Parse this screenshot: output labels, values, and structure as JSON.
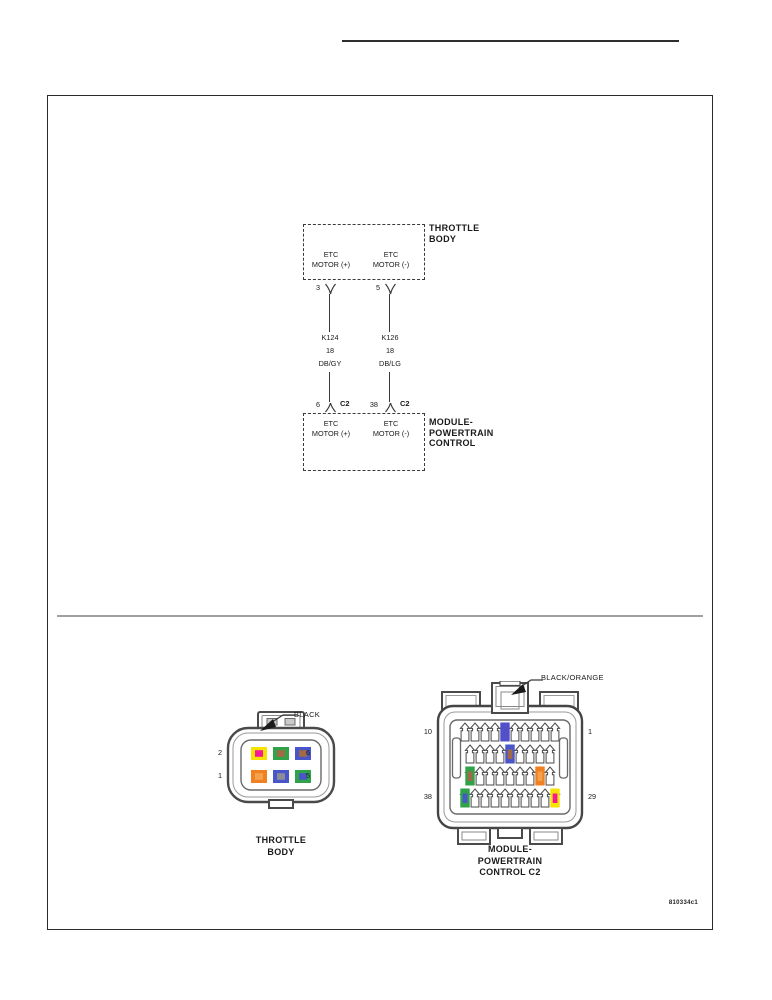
{
  "page": {
    "doc_code": "810334c1"
  },
  "schematic": {
    "tb_title_l1": "THROTTLE",
    "tb_title_l2": "BODY",
    "tb_sig_left_l1": "ETC",
    "tb_sig_left_l2": "MOTOR (+)",
    "tb_sig_right_l1": "ETC",
    "tb_sig_right_l2": "MOTOR (-)",
    "tb_pin_left": "3",
    "tb_pin_right": "5",
    "wire_left_l1": "K124",
    "wire_left_l2": "18",
    "wire_left_l3": "DB/GY",
    "wire_right_l1": "K126",
    "wire_right_l2": "18",
    "wire_right_l3": "DB/LG",
    "pcm_pin_left": "6",
    "pcm_conn_left": "C2",
    "pcm_pin_right": "38",
    "pcm_conn_right": "C2",
    "pcm_sig_left_l1": "ETC",
    "pcm_sig_left_l2": "MOTOR (+)",
    "pcm_sig_right_l1": "ETC",
    "pcm_sig_right_l2": "MOTOR (-)",
    "pcm_title_l1": "MODULE-",
    "pcm_title_l2": "POWERTRAIN",
    "pcm_title_l3": "CONTROL"
  },
  "tb_connector": {
    "color_label": "BLACK",
    "caption_l1": "THROTTLE",
    "caption_l2": "BODY",
    "pin_top_left": "2",
    "pin_bottom_left": "1",
    "pin_top_right": "6",
    "pin_bottom_right": "5",
    "cavities": {
      "pin2": {
        "box": "#f6e400",
        "center": "#f5189b"
      },
      "pin4": {
        "box": "#2fa24a",
        "center": "#a06a46"
      },
      "pin6": {
        "box": "#4956c9",
        "center": "#a06a46"
      },
      "pin1": {
        "box": "#f08020",
        "center": "#f4a24e"
      },
      "pin3": {
        "box": "#4956c9",
        "center": "#8d8d96"
      },
      "pin5": {
        "box": "#2fa24a",
        "center": "#4956c9"
      }
    }
  },
  "pcm_connector": {
    "color_label": "BLACK/ORANGE",
    "caption_l1": "MODULE-",
    "caption_l2": "POWERTRAIN",
    "caption_l3": "CONTROL C2",
    "pin_top_left": "10",
    "pin_top_right": "1",
    "pin_bottom_left": "38",
    "pin_bottom_right": "29",
    "highlights": {
      "pin6": {
        "box": "#5150c8",
        "center": "#5150c8"
      },
      "pin15": {
        "box": "#4956c9",
        "center": "#a06a46"
      },
      "pin28": {
        "box": "#2fa24a",
        "center": "#a06a46"
      },
      "pin21": {
        "box": "#f08020",
        "center": "#f4a24e"
      },
      "pin38": {
        "box": "#2fa24a",
        "center": "#4956c9"
      },
      "pin29": {
        "box": "#f6e400",
        "center": "#f5189b"
      }
    }
  }
}
